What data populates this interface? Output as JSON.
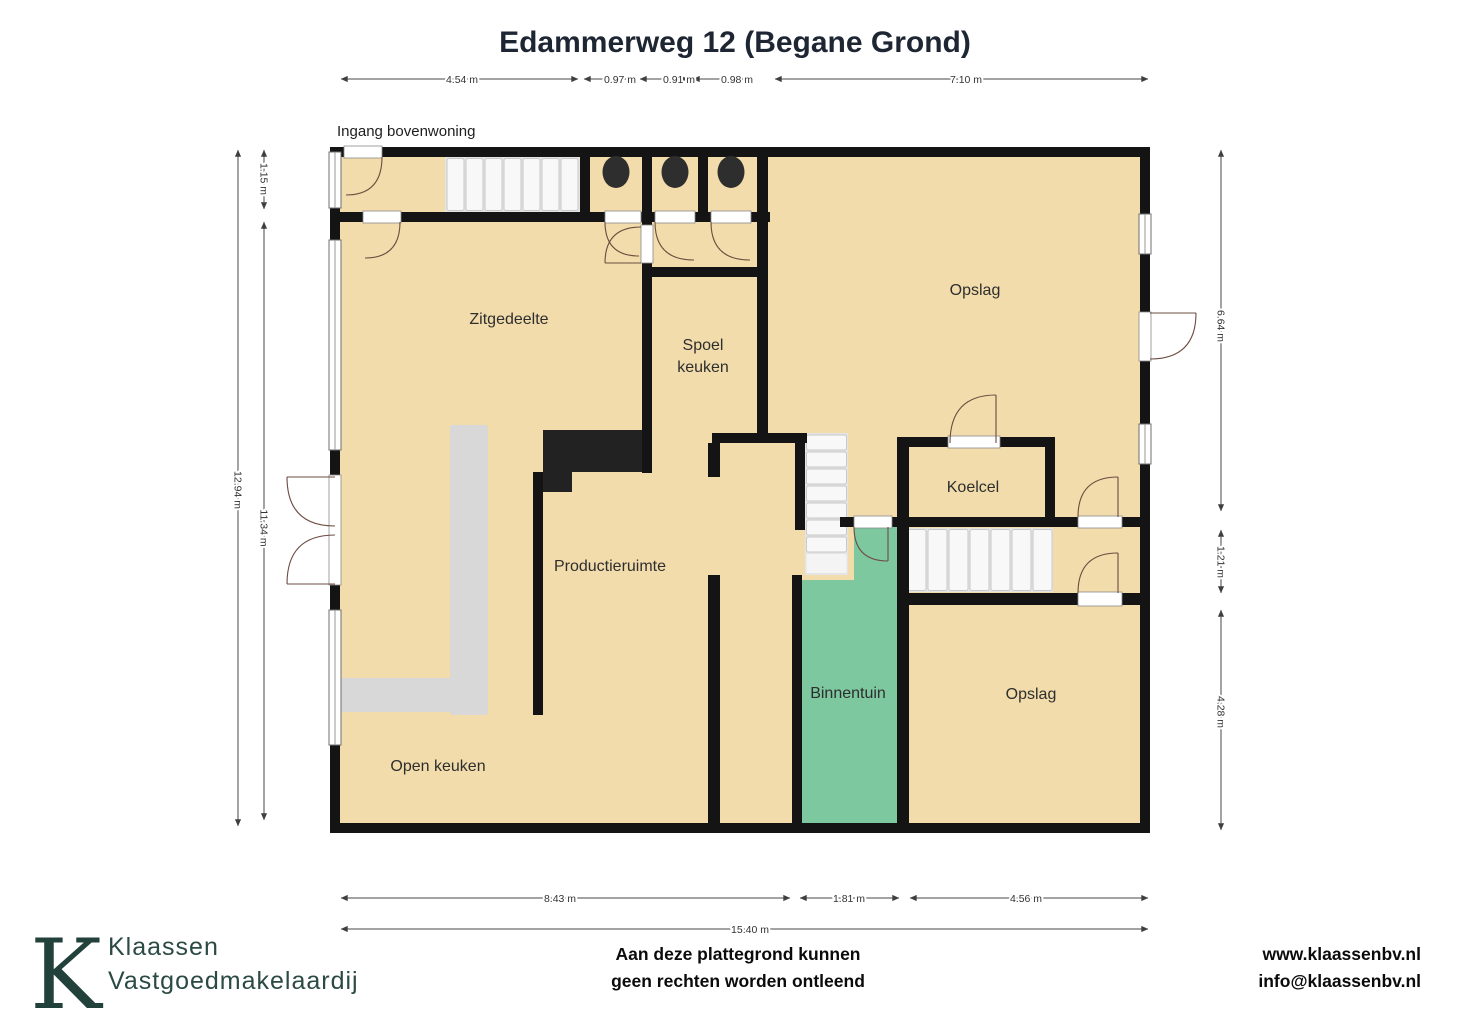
{
  "title": "Edammerweg 12 (Begane Grond)",
  "entrance_note": "Ingang bovenwoning",
  "rooms": {
    "zitgedeelte": "Zitgedeelte",
    "spoelkeuken": [
      "Spoel",
      "keuken"
    ],
    "opslag_top": "Opslag",
    "koelcel": "Koelcel",
    "productieruimte": "Productieruimte",
    "binnentuin": "Binnentuin",
    "opslag_bottom": "Opslag",
    "open_keuken": "Open keuken"
  },
  "dimensions": {
    "top": [
      "4.54 m",
      "0.97 m",
      "0.91 m",
      "0.98 m",
      "7.10 m"
    ],
    "left": [
      "1.15 m",
      "12.94 m",
      "11.34 m"
    ],
    "right": [
      "6.64 m",
      "1.21 m",
      "4.28 m"
    ],
    "bottom": [
      "8.43 m",
      "1.81 m",
      "4.56 m"
    ],
    "total_width": "15.40 m"
  },
  "footer": {
    "logo_letter": "K",
    "brand_name": "Klaassen",
    "brand_suffix": "Vastgoedmakelaardij",
    "disclaimer": [
      "Aan deze plattegrond kunnen",
      "geen rechten worden ontleend"
    ],
    "website": "www.klaassenbv.nl",
    "email": "info@klaassenbv.nl"
  },
  "colors": {
    "floor": "#f2dcab",
    "garden": "#7ec8a0",
    "wall": "#141414",
    "stairs": "#e4e4e4",
    "counter_dark": "#222222",
    "counter_light": "#d8d8d8",
    "brand": "#21413a"
  }
}
